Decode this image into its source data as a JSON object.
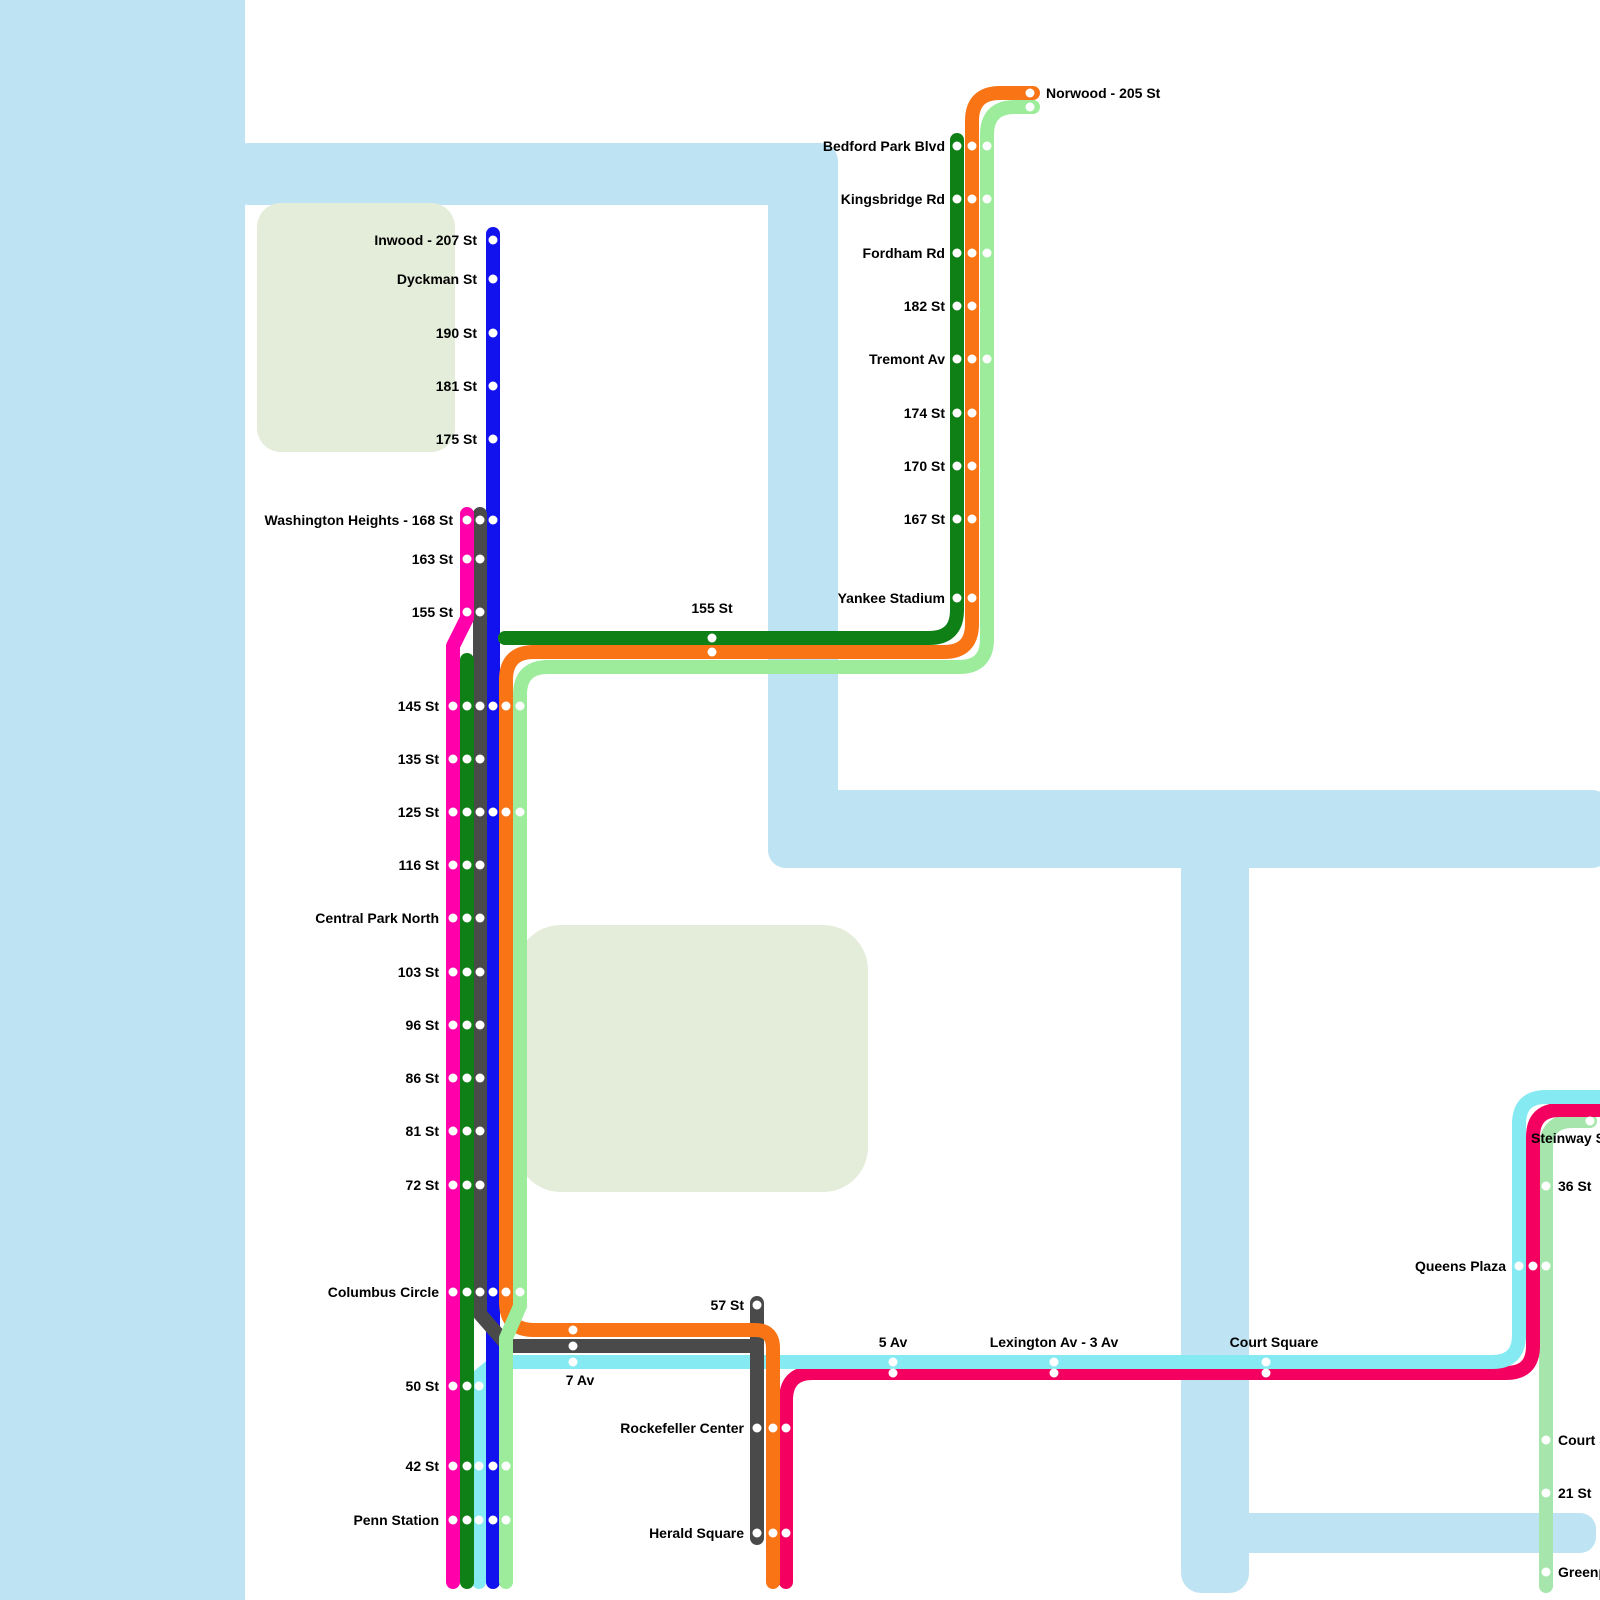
{
  "map": {
    "title": "Subway route map",
    "canvas": {
      "width": 1600,
      "height": 1600,
      "background": "#ffffff"
    },
    "colors": {
      "water": "#bee4f4",
      "park": "#e3edd9",
      "label": "#000000",
      "station_dot": "#ffffff",
      "line_pink": "#ff00aa",
      "line_dark_green": "#0f8015",
      "line_gray": "#4a4a4a",
      "line_blue": "#1212ee",
      "line_orange": "#f97415",
      "line_light_green": "#9cec9c",
      "line_cyan": "#85eaf2",
      "line_crimson": "#f40060",
      "line_mint": "#a6e6ad"
    },
    "line_style": {
      "stroke_width": 14,
      "dot_radius": 4.5
    },
    "water": [
      {
        "name": "hudson-river",
        "x": 0,
        "y": 0,
        "w": 245,
        "h": 1600,
        "r": 0
      },
      {
        "name": "harlem-river-arm",
        "x": 230,
        "y": 143,
        "w": 608,
        "h": 62,
        "r": 18
      },
      {
        "name": "harlem-river-vertical",
        "x": 768,
        "y": 160,
        "w": 70,
        "h": 708,
        "r": 18
      },
      {
        "name": "harlem-river-horizontal",
        "x": 768,
        "y": 790,
        "w": 842,
        "h": 78,
        "r": 18
      },
      {
        "name": "east-river-vertical",
        "x": 1181,
        "y": 830,
        "w": 68,
        "h": 763,
        "r": 20
      },
      {
        "name": "newtown-creek",
        "x": 1215,
        "y": 1513,
        "w": 381,
        "h": 40,
        "r": 16
      }
    ],
    "parks": [
      {
        "name": "inwood-park",
        "x": 257,
        "y": 203,
        "w": 198,
        "h": 249,
        "r": 24
      },
      {
        "name": "central-park",
        "x": 516,
        "y": 925,
        "w": 352,
        "h": 267,
        "r": 45
      }
    ],
    "lines": [
      {
        "id": "line-mint-g",
        "color": "#a6e6ad",
        "path": "M 1590 1121 L 1573 1121 Q 1546 1121 1546 1148 L 1546 1586"
      },
      {
        "id": "line-crimson",
        "color": "#f40060",
        "path": "M 1604 1110 L 1560 1110 Q 1533 1110 1533 1137 L 1533 1346 Q 1533 1373 1506 1373 L 813 1373 Q 786 1373 786 1400 L 786 1582"
      },
      {
        "id": "line-cyan",
        "color": "#85eaf2",
        "path": "M 1604 1097 L 1546 1097 Q 1519 1097 1519 1124 L 1519 1335 Q 1519 1362 1492 1362 L 496 1362 L 479 1376 L 479 1582"
      },
      {
        "id": "line-blue",
        "color": "#1212ee",
        "path": "M 493 234 L 493 1582"
      },
      {
        "id": "line-gray-main",
        "color": "#4a4a4a",
        "path": "M 480 514 L 480 1314 L 508 1346 L 757 1346 L 757 1538"
      },
      {
        "id": "line-gray-57st-stub",
        "color": "#4a4a4a",
        "path": "M 757 1346 L 757 1303"
      },
      {
        "id": "line-orange",
        "color": "#f97415",
        "path": "M 1033 93 L 1000 93 Q 972 93 972 121 L 972 624 Q 972 652 944 652 L 534 652 Q 506 652 506 680 L 506 1302 Q 506 1330 534 1330 L 755 1330 Q 773 1330 773 1348 L 773 1582"
      },
      {
        "id": "line-light-green",
        "color": "#9cec9c",
        "path": "M 1033 107 L 1015 107 Q 987 107 987 135 L 987 639 Q 987 667 959 667 L 548 667 Q 520 667 520 695 L 520 1306 L 506 1338 L 506 1582"
      },
      {
        "id": "line-pink",
        "color": "#ff00aa",
        "path": "M 467 514 L 467 618 L 453 646 L 453 1582"
      },
      {
        "id": "line-dark-green-bronx",
        "color": "#0f8015",
        "path": "M 957 140 L 957 610 Q 957 638 929 638 L 505 638"
      },
      {
        "id": "line-dark-green-cpw",
        "color": "#0f8015",
        "path": "M 467 660 L 467 1582"
      }
    ],
    "stations": [
      {
        "name": "norwood-205-st",
        "label": "Norwood - 205 St",
        "anchor": "start",
        "lx": 1046,
        "ly": 93,
        "dots": [
          [
            1030,
            93
          ],
          [
            1030,
            107
          ]
        ]
      },
      {
        "name": "bedford-park-blvd",
        "label": "Bedford Park Blvd",
        "anchor": "end",
        "lx": 945,
        "ly": 146,
        "dots": [
          [
            957,
            146
          ],
          [
            972,
            146
          ],
          [
            987,
            146
          ]
        ]
      },
      {
        "name": "kingsbridge-rd",
        "label": "Kingsbridge Rd",
        "anchor": "end",
        "lx": 945,
        "ly": 199,
        "dots": [
          [
            957,
            199
          ],
          [
            972,
            199
          ],
          [
            987,
            199
          ]
        ]
      },
      {
        "name": "fordham-rd",
        "label": "Fordham Rd",
        "anchor": "end",
        "lx": 945,
        "ly": 253,
        "dots": [
          [
            957,
            253
          ],
          [
            972,
            253
          ],
          [
            987,
            253
          ]
        ]
      },
      {
        "name": "182-st",
        "label": "182 St",
        "anchor": "end",
        "lx": 945,
        "ly": 306,
        "dots": [
          [
            957,
            306
          ],
          [
            972,
            306
          ]
        ]
      },
      {
        "name": "tremont-av",
        "label": "Tremont Av",
        "anchor": "end",
        "lx": 945,
        "ly": 359,
        "dots": [
          [
            957,
            359
          ],
          [
            972,
            359
          ],
          [
            987,
            359
          ]
        ]
      },
      {
        "name": "174-st",
        "label": "174 St",
        "anchor": "end",
        "lx": 945,
        "ly": 413,
        "dots": [
          [
            957,
            413
          ],
          [
            972,
            413
          ]
        ]
      },
      {
        "name": "170-st",
        "label": "170 St",
        "anchor": "end",
        "lx": 945,
        "ly": 466,
        "dots": [
          [
            957,
            466
          ],
          [
            972,
            466
          ]
        ]
      },
      {
        "name": "167-st",
        "label": "167 St",
        "anchor": "end",
        "lx": 945,
        "ly": 519,
        "dots": [
          [
            957,
            519
          ],
          [
            972,
            519
          ]
        ]
      },
      {
        "name": "yankee-stadium",
        "label": "Yankee Stadium",
        "anchor": "end",
        "lx": 945,
        "ly": 598,
        "dots": [
          [
            957,
            598
          ],
          [
            972,
            598
          ]
        ]
      },
      {
        "name": "155-st-harlem",
        "label": "155 St",
        "anchor": "middle",
        "lx": 712,
        "ly": 608,
        "dots": [
          [
            712,
            638
          ],
          [
            712,
            652
          ]
        ]
      },
      {
        "name": "inwood-207-st",
        "label": "Inwood - 207 St",
        "anchor": "end",
        "lx": 477,
        "ly": 240,
        "dots": [
          [
            493,
            240
          ]
        ]
      },
      {
        "name": "dyckman-st",
        "label": "Dyckman St",
        "anchor": "end",
        "lx": 477,
        "ly": 279,
        "dots": [
          [
            493,
            279
          ]
        ]
      },
      {
        "name": "190-st",
        "label": "190 St",
        "anchor": "end",
        "lx": 477,
        "ly": 333,
        "dots": [
          [
            493,
            333
          ]
        ]
      },
      {
        "name": "181-st",
        "label": "181 St",
        "anchor": "end",
        "lx": 477,
        "ly": 386,
        "dots": [
          [
            493,
            386
          ]
        ]
      },
      {
        "name": "175-st",
        "label": "175 St",
        "anchor": "end",
        "lx": 477,
        "ly": 439,
        "dots": [
          [
            493,
            439
          ]
        ]
      },
      {
        "name": "washington-heights-168-st",
        "label": "Washington Heights - 168 St",
        "anchor": "end",
        "lx": 453,
        "ly": 520,
        "dots": [
          [
            467,
            520
          ],
          [
            480,
            520
          ],
          [
            493,
            520
          ]
        ]
      },
      {
        "name": "163-st",
        "label": "163 St",
        "anchor": "end",
        "lx": 453,
        "ly": 559,
        "dots": [
          [
            467,
            559
          ],
          [
            480,
            559
          ]
        ]
      },
      {
        "name": "155-st-washington",
        "label": "155 St",
        "anchor": "end",
        "lx": 453,
        "ly": 612,
        "dots": [
          [
            467,
            612
          ],
          [
            480,
            612
          ]
        ]
      },
      {
        "name": "145-st",
        "label": "145 St",
        "anchor": "end",
        "lx": 439,
        "ly": 706,
        "dots": [
          [
            453,
            706
          ],
          [
            467,
            706
          ],
          [
            480,
            706
          ],
          [
            493,
            706
          ],
          [
            506,
            706
          ],
          [
            520,
            706
          ]
        ]
      },
      {
        "name": "135-st",
        "label": "135 St",
        "anchor": "end",
        "lx": 439,
        "ly": 759,
        "dots": [
          [
            453,
            759
          ],
          [
            467,
            759
          ],
          [
            480,
            759
          ]
        ]
      },
      {
        "name": "125-st",
        "label": "125 St",
        "anchor": "end",
        "lx": 439,
        "ly": 812,
        "dots": [
          [
            453,
            812
          ],
          [
            467,
            812
          ],
          [
            480,
            812
          ],
          [
            493,
            812
          ],
          [
            506,
            812
          ],
          [
            520,
            812
          ]
        ]
      },
      {
        "name": "116-st",
        "label": "116 St",
        "anchor": "end",
        "lx": 439,
        "ly": 865,
        "dots": [
          [
            453,
            865
          ],
          [
            467,
            865
          ],
          [
            480,
            865
          ]
        ]
      },
      {
        "name": "central-park-north",
        "label": "Central Park North",
        "anchor": "end",
        "lx": 439,
        "ly": 918,
        "dots": [
          [
            453,
            918
          ],
          [
            467,
            918
          ],
          [
            480,
            918
          ]
        ]
      },
      {
        "name": "103-st",
        "label": "103 St",
        "anchor": "end",
        "lx": 439,
        "ly": 972,
        "dots": [
          [
            453,
            972
          ],
          [
            467,
            972
          ],
          [
            480,
            972
          ]
        ]
      },
      {
        "name": "96-st",
        "label": "96 St",
        "anchor": "end",
        "lx": 439,
        "ly": 1025,
        "dots": [
          [
            453,
            1025
          ],
          [
            467,
            1025
          ],
          [
            480,
            1025
          ]
        ]
      },
      {
        "name": "86-st",
        "label": "86 St",
        "anchor": "end",
        "lx": 439,
        "ly": 1078,
        "dots": [
          [
            453,
            1078
          ],
          [
            467,
            1078
          ],
          [
            480,
            1078
          ]
        ]
      },
      {
        "name": "81-st",
        "label": "81 St",
        "anchor": "end",
        "lx": 439,
        "ly": 1131,
        "dots": [
          [
            453,
            1131
          ],
          [
            467,
            1131
          ],
          [
            480,
            1131
          ]
        ]
      },
      {
        "name": "72-st",
        "label": "72 St",
        "anchor": "end",
        "lx": 439,
        "ly": 1185,
        "dots": [
          [
            453,
            1185
          ],
          [
            467,
            1185
          ],
          [
            480,
            1185
          ]
        ]
      },
      {
        "name": "columbus-circle",
        "label": "Columbus Circle",
        "anchor": "end",
        "lx": 439,
        "ly": 1292,
        "dots": [
          [
            453,
            1292
          ],
          [
            467,
            1292
          ],
          [
            480,
            1292
          ],
          [
            493,
            1292
          ],
          [
            506,
            1292
          ],
          [
            520,
            1292
          ]
        ]
      },
      {
        "name": "57-st",
        "label": "57 St",
        "anchor": "end",
        "lx": 744,
        "ly": 1305,
        "dots": [
          [
            757,
            1305
          ]
        ]
      },
      {
        "name": "7-av",
        "label": "7 Av",
        "anchor": "middle",
        "lx": 580,
        "ly": 1380,
        "dots": [
          [
            573,
            1330
          ],
          [
            573,
            1346
          ],
          [
            573,
            1362
          ]
        ]
      },
      {
        "name": "50-st",
        "label": "50 St",
        "anchor": "end",
        "lx": 439,
        "ly": 1386,
        "dots": [
          [
            453,
            1386
          ],
          [
            467,
            1386
          ],
          [
            479,
            1386
          ]
        ]
      },
      {
        "name": "42-st",
        "label": "42 St",
        "anchor": "end",
        "lx": 439,
        "ly": 1466,
        "dots": [
          [
            453,
            1466
          ],
          [
            467,
            1466
          ],
          [
            479,
            1466
          ],
          [
            493,
            1466
          ],
          [
            506,
            1466
          ]
        ]
      },
      {
        "name": "penn-station",
        "label": "Penn Station",
        "anchor": "end",
        "lx": 439,
        "ly": 1520,
        "dots": [
          [
            453,
            1520
          ],
          [
            467,
            1520
          ],
          [
            479,
            1520
          ],
          [
            493,
            1520
          ],
          [
            506,
            1520
          ]
        ]
      },
      {
        "name": "rockefeller-center",
        "label": "Rockefeller Center",
        "anchor": "end",
        "lx": 744,
        "ly": 1428,
        "dots": [
          [
            757,
            1428
          ],
          [
            773,
            1428
          ],
          [
            786,
            1428
          ]
        ]
      },
      {
        "name": "herald-square",
        "label": "Herald Square",
        "anchor": "end",
        "lx": 744,
        "ly": 1533,
        "dots": [
          [
            757,
            1533
          ],
          [
            773,
            1533
          ],
          [
            786,
            1533
          ]
        ]
      },
      {
        "name": "5-av",
        "label": "5 Av",
        "anchor": "middle",
        "lx": 893,
        "ly": 1342,
        "dots": [
          [
            893,
            1362
          ],
          [
            893,
            1373
          ]
        ]
      },
      {
        "name": "lexington-av-3-av",
        "label": "Lexington Av - 3 Av",
        "anchor": "middle",
        "lx": 1054,
        "ly": 1342,
        "dots": [
          [
            1054,
            1362
          ],
          [
            1054,
            1373
          ]
        ]
      },
      {
        "name": "court-square",
        "label": "Court Square",
        "anchor": "middle",
        "lx": 1274,
        "ly": 1342,
        "dots": [
          [
            1266,
            1362
          ],
          [
            1266,
            1373
          ]
        ]
      },
      {
        "name": "queens-plaza",
        "label": "Queens Plaza",
        "anchor": "end",
        "lx": 1506,
        "ly": 1266,
        "dots": [
          [
            1519,
            1266
          ],
          [
            1533,
            1266
          ],
          [
            1546,
            1266
          ]
        ]
      },
      {
        "name": "steinway-st",
        "label": "Steinway St",
        "anchor": "start",
        "lx": 1531,
        "ly": 1138,
        "dots": [
          [
            1590,
            1121
          ]
        ]
      },
      {
        "name": "36-st",
        "label": "36 St",
        "anchor": "start",
        "lx": 1558,
        "ly": 1186,
        "dots": [
          [
            1546,
            1186
          ]
        ]
      },
      {
        "name": "court-sq",
        "label": "Court Sq",
        "anchor": "start",
        "lx": 1558,
        "ly": 1440,
        "dots": [
          [
            1546,
            1440
          ]
        ]
      },
      {
        "name": "21-st",
        "label": "21 St",
        "anchor": "start",
        "lx": 1558,
        "ly": 1493,
        "dots": [
          [
            1546,
            1493
          ]
        ]
      },
      {
        "name": "greenpoint-av",
        "label": "Greenpoint Av",
        "anchor": "start",
        "lx": 1558,
        "ly": 1572,
        "dots": [
          [
            1546,
            1572
          ]
        ]
      }
    ]
  }
}
